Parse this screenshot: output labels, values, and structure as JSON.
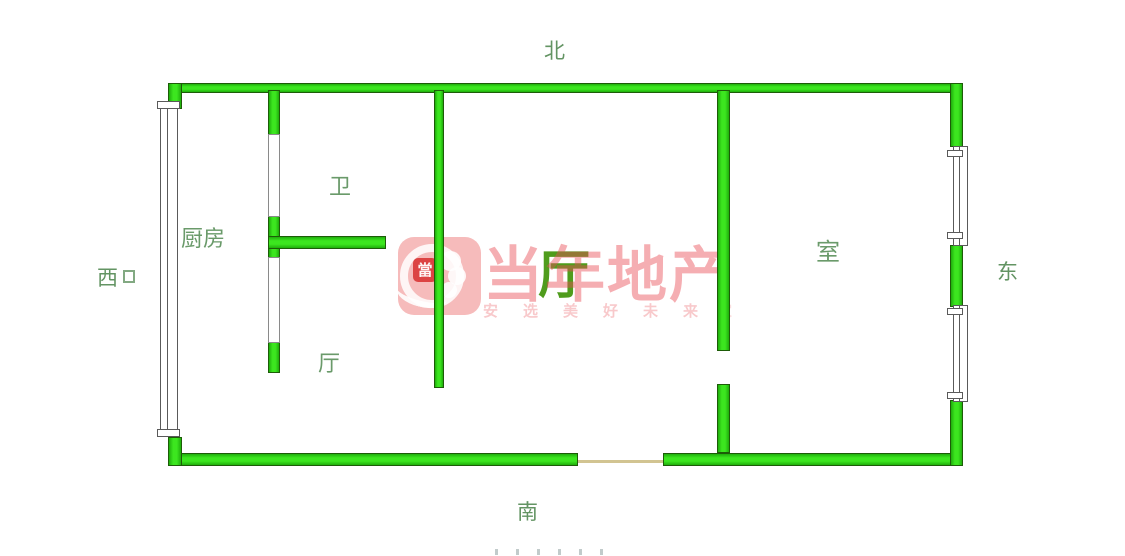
{
  "compass": {
    "north": "北",
    "south": "南",
    "west": "西",
    "east": "东"
  },
  "rooms": {
    "kitchen": "厨房",
    "bathroom": "卫",
    "hall_small": "厅",
    "living_room": "厅",
    "bedroom": "室"
  },
  "watermark": {
    "brand": "当年地产",
    "slogan": "安选美好未来",
    "slogan_tail": "家",
    "seal_char": "當"
  },
  "colors": {
    "wall_fill": "#2bd412",
    "wall_outline": "#1d5c08",
    "label_green": "#6a9a6a",
    "compass_green": "#639463",
    "hall_label_green": "#4f9c1c",
    "watermark_red": "#e74c54",
    "threshold_tan": "#d2c492"
  }
}
